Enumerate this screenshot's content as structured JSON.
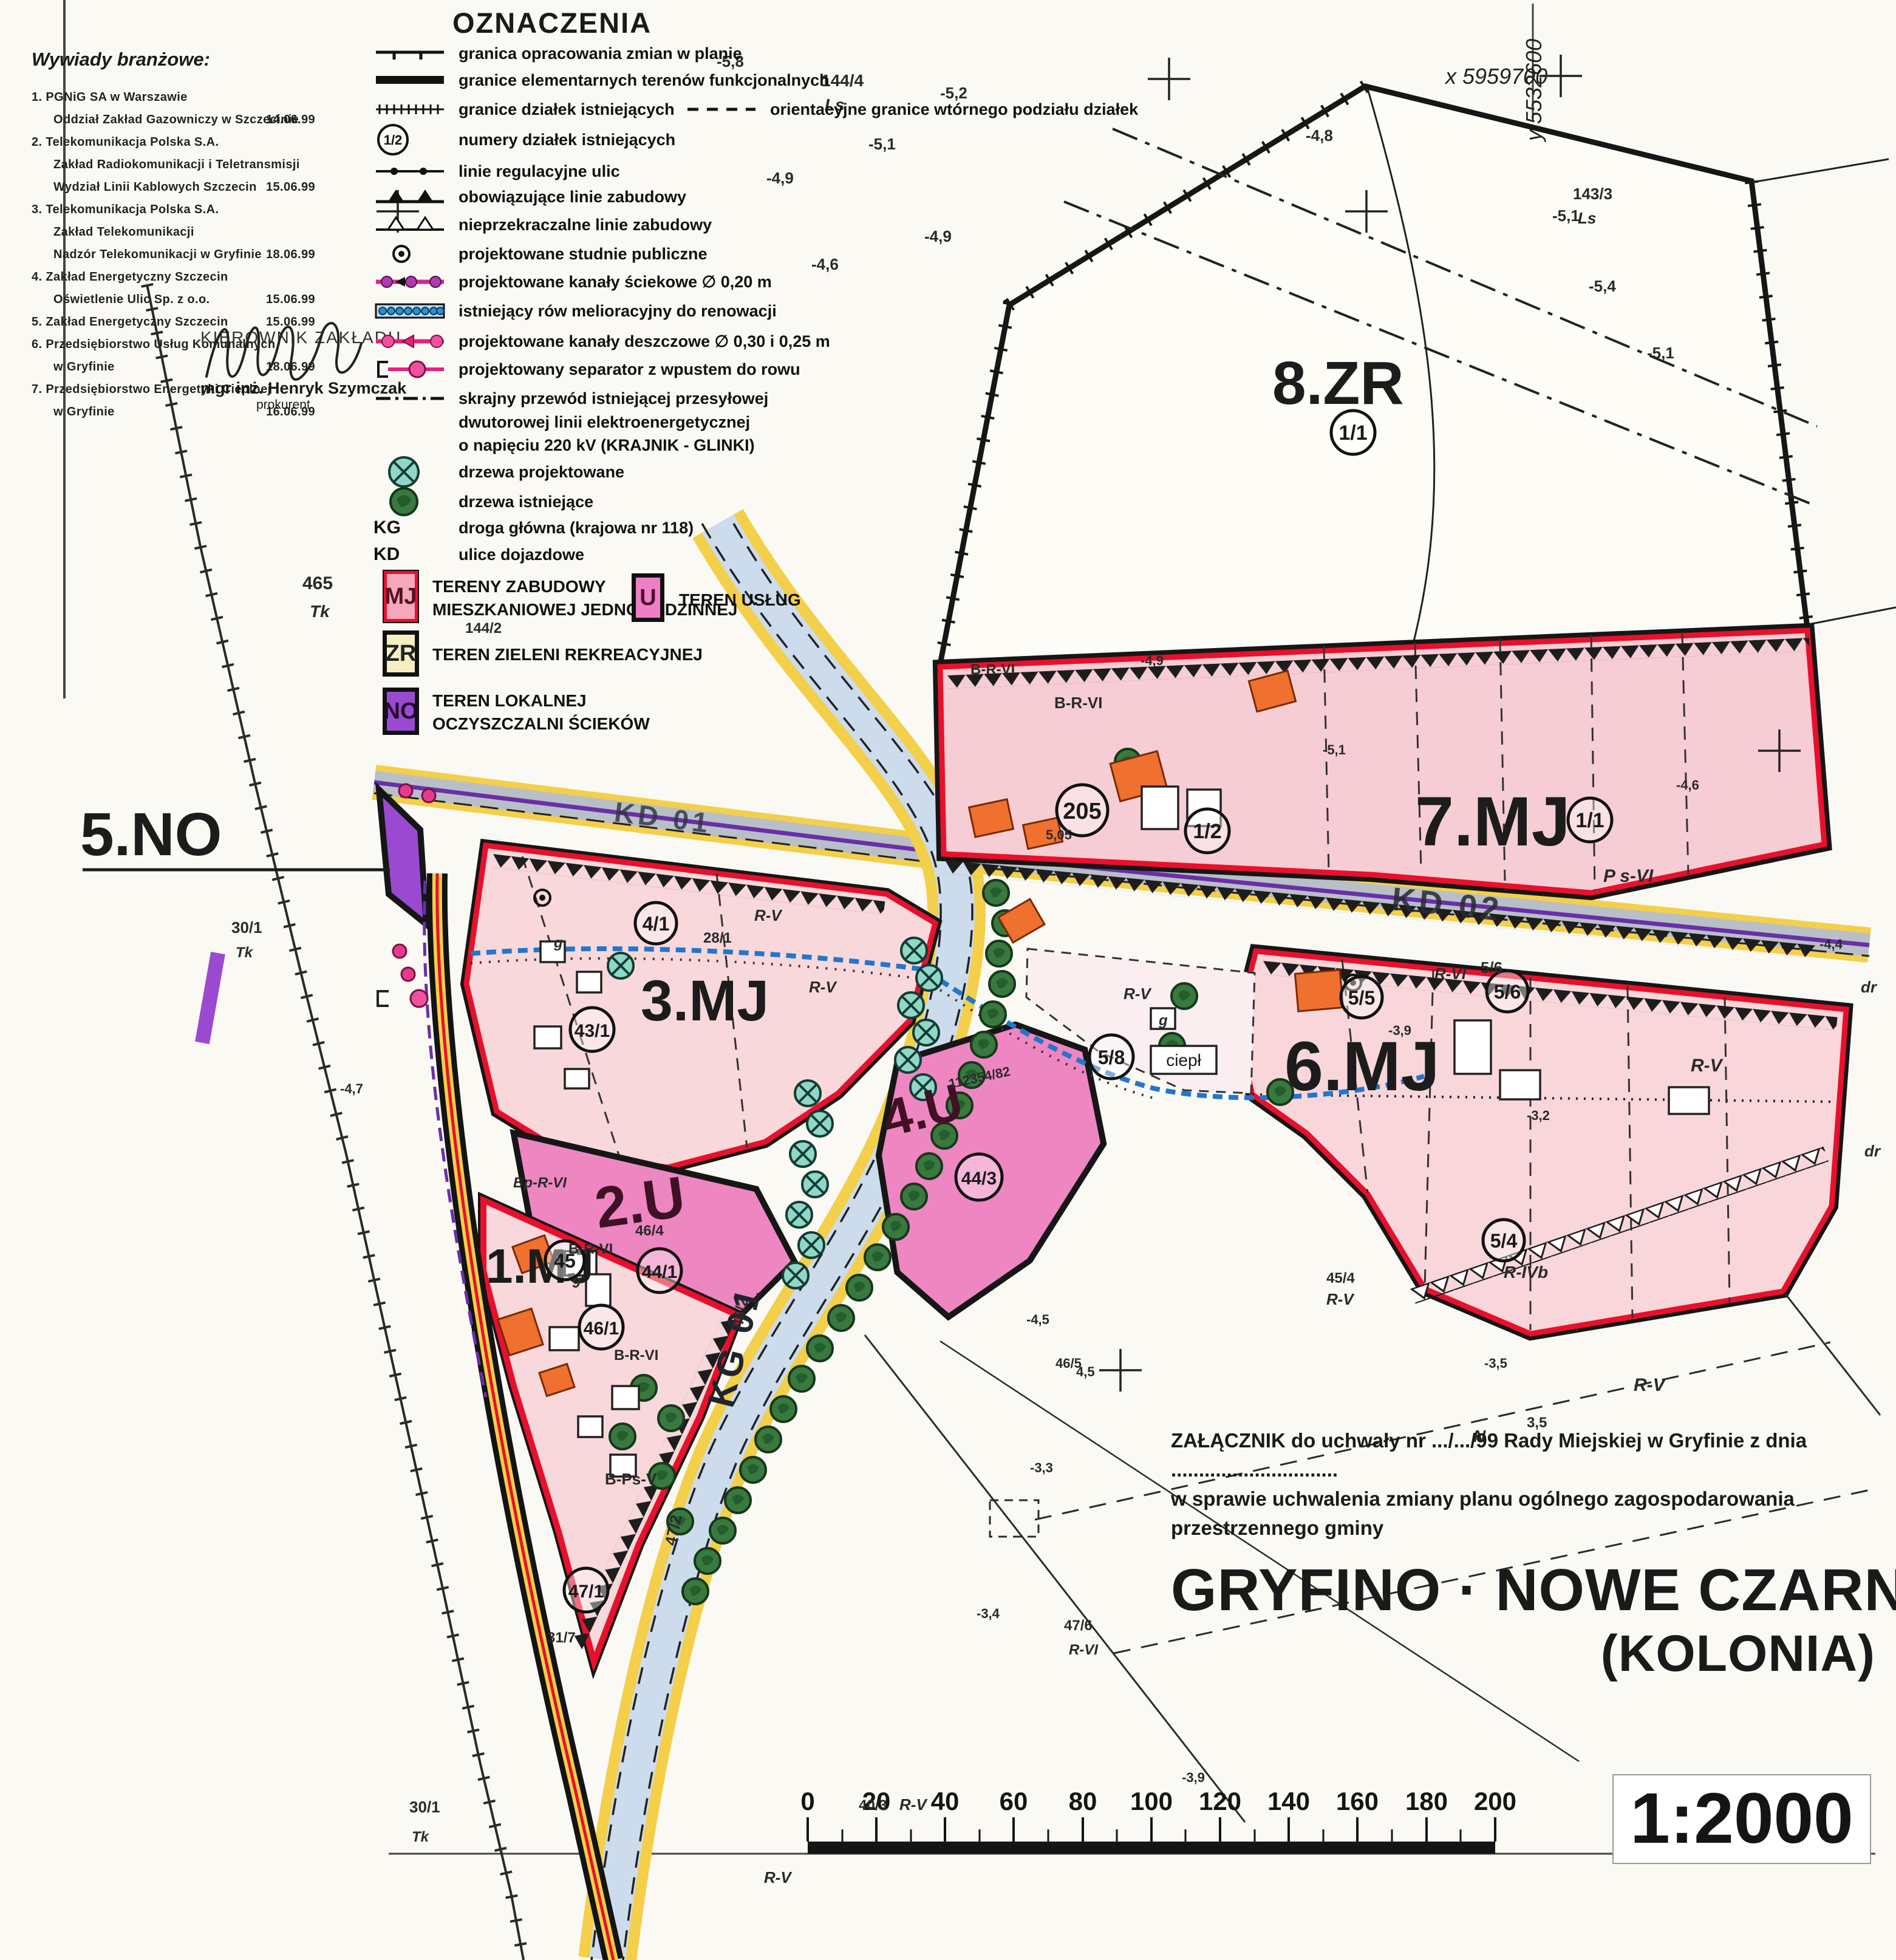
{
  "surveys": {
    "title": "Wywiady branżowe:",
    "items": [
      {
        "l1": "1. PGNiG SA w Warszawie",
        "l2": "Oddział Zakład Gazowniczy w Szczecinie",
        "date": "14.06.99"
      },
      {
        "l1": "2. Telekomunikacja Polska S.A.",
        "l2": "Zakład Radiokomunikacji i Teletransmisji",
        "l3": "Wydział Linii Kablowych Szczecin",
        "date": "15.06.99"
      },
      {
        "l1": "3. Telekomunikacja Polska S.A.",
        "l2": "Zakład Telekomunikacji",
        "l3": "Nadzór Telekomunikacji w Gryfinie",
        "date": "18.06.99"
      },
      {
        "l1": "4. Zakład Energetyczny Szczecin",
        "l2": "Oświetlenie Ulic Sp. z o.o.",
        "date": "15.06.99"
      },
      {
        "l1": "5. Zakład Energetyczny Szczecin",
        "date": "15.06.99"
      },
      {
        "l1": "6. Przedsiębiorstwo Usług Komunalnych",
        "l2": "w Gryfinie",
        "date": "18.06.99"
      },
      {
        "l1": "7. Przedsiębiorstwo Energetyki Cieplnej",
        "l2": "w Gryfinie",
        "date": "16.06.99"
      }
    ]
  },
  "signature": {
    "role": "KIEROWNIK ZAKŁADU",
    "name": "mgr inż. Henryk Szymczak",
    "title": "prokurent"
  },
  "legend": {
    "title": "OZNACZENIA",
    "rows": [
      "granica opracowania zmian w planie",
      "granice elementarnych terenów funkcjonalnych",
      "granice działek istniejących",
      "numery działek istniejących",
      "linie regulacyjne ulic",
      "obowiązujące linie zabudowy",
      "nieprzekraczalne linie zabudowy",
      "projektowane studnie publiczne",
      "projektowane kanały ściekowe ∅ 0,20 m",
      "istniejący rów melioracyjny do renowacji",
      "projektowane kanały deszczowe ∅ 0,30 i 0,25 m",
      "projektowany separator z wpustem do rowu",
      "skrajny przewód istniejącej przesyłowej",
      "dwutorowej linii elektroenergetycznej",
      "o napięciu 220 kV (KRAJNIK - GLINKI)",
      "drzewa projektowane",
      "drzewa istniejące"
    ],
    "right_row": "orientacyjne granice wtórnego podziału działek",
    "parcel_symbol": "1/2",
    "kg": {
      "code": "KG",
      "label": "droga główna (krajowa nr 118)"
    },
    "kd": {
      "code": "KD",
      "label": "ulice dojazdowe"
    },
    "zones": [
      {
        "code": "MJ",
        "label1": "TERENY ZABUDOWY",
        "label2": "MIESZKANIOWEJ JEDNORODZINNEJ",
        "fill": "#f5a8bc",
        "accent": "#e8102c"
      },
      {
        "code": "U",
        "label1": "TEREN USŁUG",
        "fill": "#ee7fc4"
      },
      {
        "code": "ZR",
        "label1": "TEREN ZIELENI REKREACYJNEJ",
        "fill": "#f5efc2"
      },
      {
        "code": "NO",
        "label1": "TEREN LOKALNEJ",
        "label2": "OCZYSZCZALNI ŚCIEKÓW",
        "fill": "#9a4ad0"
      }
    ]
  },
  "map": {
    "zones": [
      "8.ZR",
      "7.MJ",
      "6.MJ",
      "3.MJ",
      "5.NO",
      "2.U",
      "4.U",
      "1.MJ"
    ],
    "roads": {
      "kg": "KG 01",
      "kd2": "KD 02",
      "kd1": "KD 01"
    },
    "coords": {
      "x": "x 5959700",
      "y": "y 5532600"
    },
    "parcels": [
      "1/1",
      "205",
      "1/2",
      "1/1",
      "4/1",
      "43/1",
      "44/1",
      "45",
      "46/1",
      "47/1",
      "44/3",
      "5/8",
      "5/5",
      "5/6",
      "5/4"
    ],
    "misc": {
      "ciepl": "ciepł"
    },
    "annotations": [
      "-5,8",
      "144/4",
      "Ls",
      "-5,2",
      "-5,1",
      "-4,9",
      "-4,8",
      "143/3",
      "Ls",
      "-5,1",
      "-5,4",
      "-5,1",
      "-4,9",
      "-4,6",
      "465",
      "Tk",
      "B-R-VI",
      "B-R-VI",
      "P s-VI",
      "R-V",
      "R-V",
      "28/1",
      "R-VI",
      "5/6",
      "R-V",
      "R-IVb",
      "45/4",
      "R-V",
      "dr",
      "dr",
      "R-V",
      "N",
      "3,5",
      "R-V",
      "46/4",
      "B-Ps-V",
      "B-R-VI",
      "Bp-R-VI",
      "B-R-VI",
      "31/7",
      "30/1",
      "Tk",
      "30/1",
      "Tk",
      "R-V",
      "40/3",
      "R-V",
      "46/2",
      "47/2",
      "112354/82",
      "46/5",
      "4,5",
      "47/6",
      "R-VI",
      "-3,9",
      "-3,2",
      "-3,3",
      "-3,4",
      "-3,9",
      "-3,5",
      "144/2",
      "-4,6",
      "-5,1",
      "-4,9",
      "-4,7",
      "-4,4",
      "5,05",
      "-4,5",
      "g",
      "g",
      "9"
    ]
  },
  "title_block": {
    "line1": "ZAŁĄCZNIK do uchwały nr .../.../99 Rady Miejskiej w Gryfinie z dnia ..............................",
    "line2": "w sprawie uchwalenia zmiany planu ogólnego zagospodarowania przestrzennego gminy",
    "title": "GRYFINO · NOWE CZARNOWO",
    "subtitle": "(KOLONIA)"
  },
  "scale": {
    "ticks": [
      "0",
      "20",
      "40",
      "60",
      "80",
      "100",
      "120",
      "140",
      "160",
      "180",
      "200"
    ],
    "ratio": "1:2000"
  }
}
